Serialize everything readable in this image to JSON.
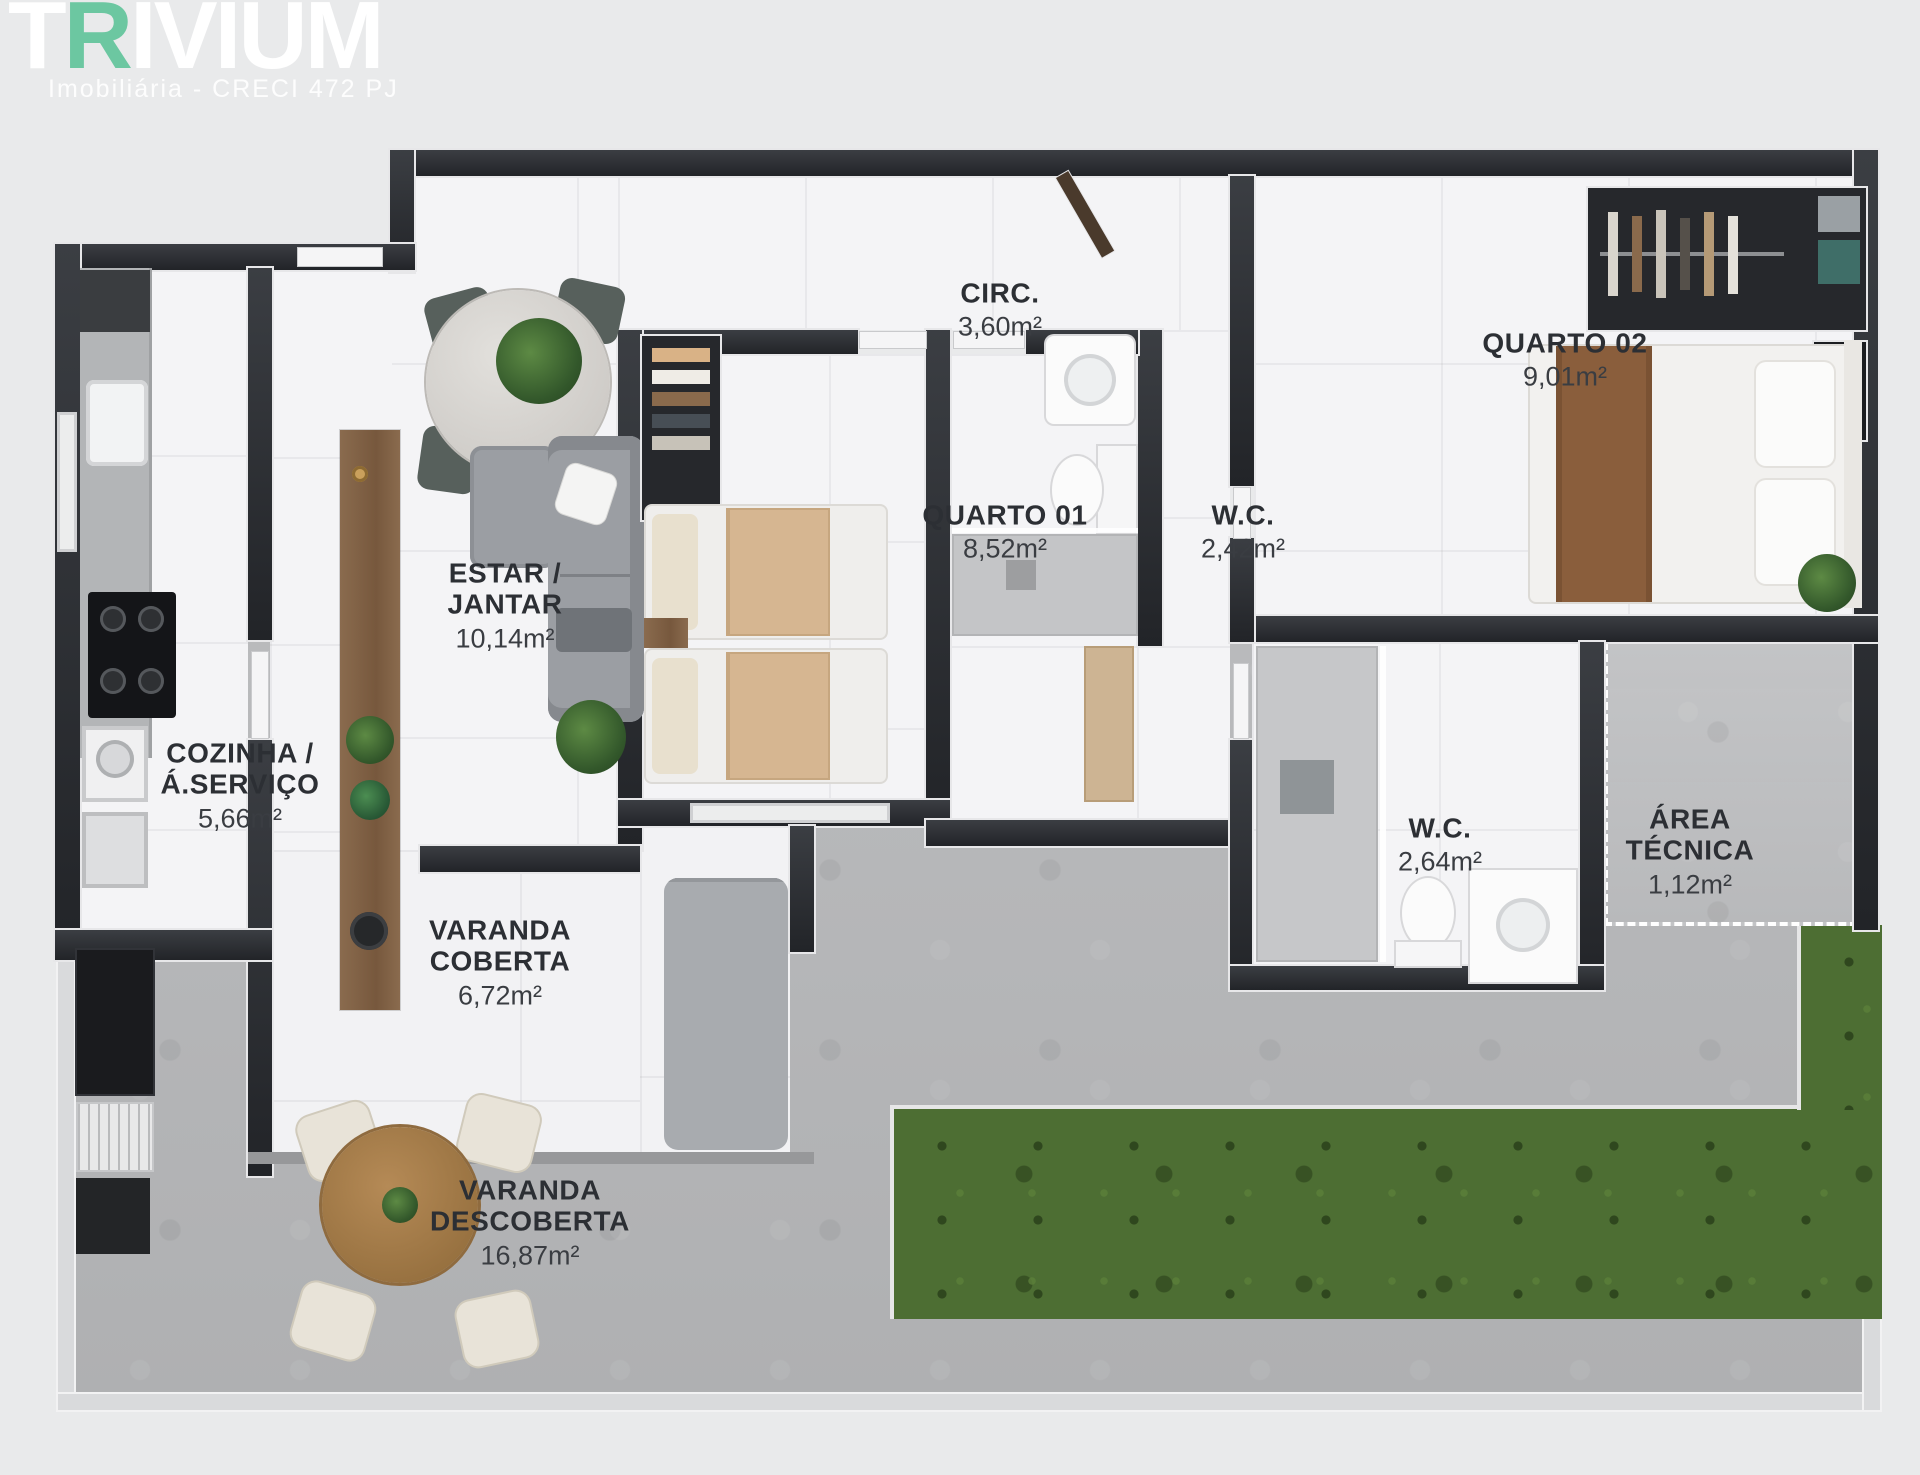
{
  "logo": {
    "brand_t": "T",
    "brand_r": "R",
    "brand_rest": "IVIUM",
    "subtitle": "Imobiliária - CRECI 472 PJ",
    "accent_color": "#6cc7a1"
  },
  "rooms": [
    {
      "id": "circ",
      "line1": "CIRC.",
      "area": "3,60m²"
    },
    {
      "id": "quarto-02",
      "line1": "QUARTO 02",
      "area": "9,01m²"
    },
    {
      "id": "quarto-01",
      "line1": "QUARTO 01",
      "area": "8,52m²"
    },
    {
      "id": "wc-1",
      "line1": "W.C.",
      "area": "2,42m²"
    },
    {
      "id": "estar-jantar",
      "line1": "ESTAR /",
      "line2": "JANTAR",
      "area": "10,14m²"
    },
    {
      "id": "cozinha-a-servico",
      "line1": "COZINHA /",
      "line2": "Á.SERVIÇO",
      "area": "5,66m²"
    },
    {
      "id": "wc-2",
      "line1": "W.C.",
      "area": "2,64m²"
    },
    {
      "id": "area-tecnica",
      "line1": "ÁREA",
      "line2": "TÉCNICA",
      "area": "1,12m²"
    },
    {
      "id": "varanda-coberta",
      "line1": "VARANDA",
      "line2": "COBERTA",
      "area": "6,72m²"
    },
    {
      "id": "varanda-descoberta",
      "line1": "VARANDA",
      "line2": "DESCOBERTA",
      "area": "16,87m²"
    }
  ],
  "colors": {
    "wall": "#282b2f",
    "floor": "#f4f4f6",
    "concrete": "#b7b8ba",
    "grass": "#4d6e33",
    "label_text": "#2c2f34",
    "logo_accent": "#6cc7a1"
  }
}
